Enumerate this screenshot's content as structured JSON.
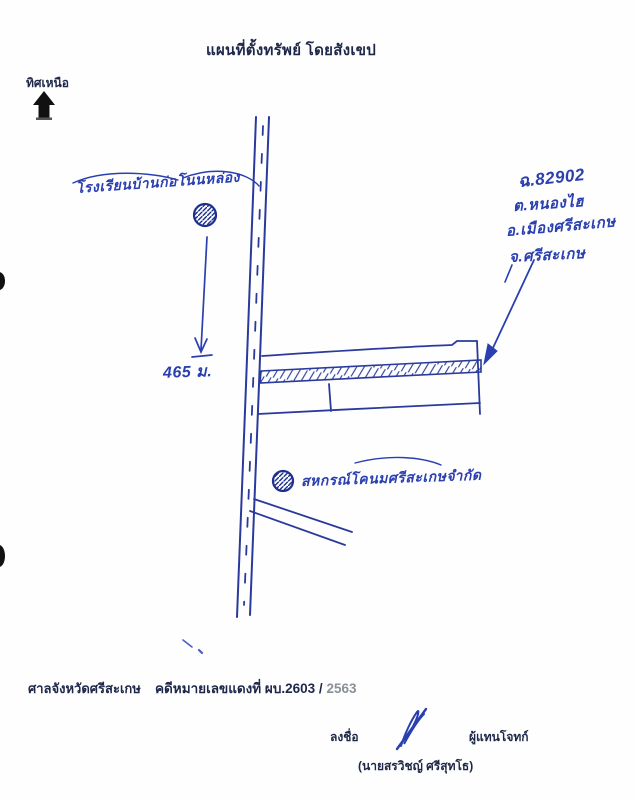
{
  "page": {
    "title": "แผนที่ตั้งทรัพย์ โดยสังเขป",
    "north_label": "ทิศเหนือ"
  },
  "map": {
    "school_label": "โรงเรียนบ้านก่อโนนหล่อง",
    "distance_label": "465 ม.",
    "parcel_note": {
      "line1": "ฉ.82902",
      "line2": "ต.หนองไฮ",
      "line3": "อ.เมืองศรีสะเกษ",
      "line4": "จ.ศรีสะเกษ"
    },
    "coop_label": "สหกรณ์โคนมศรีสะเกษจำกัด"
  },
  "footer": {
    "court_name": "ศาลจังหวัดศรีสะเกษ",
    "case_label": "คดีหมายเลขแดงที่ ผบ.2603 /",
    "case_year": "2563",
    "sign_label": "ลงชื่อ",
    "sign_role": "ผู้แทนโจทก์",
    "sign_name": "(นายสรวิชญ์ ศรีสุทโธ)"
  },
  "icons": {
    "north_arrow": "solid-up-arrow",
    "school_marker": "hatched-circle",
    "coop_marker": "hatched-circle",
    "property_strip": "hatched-band"
  },
  "colors": {
    "printed_ink": "#1e2749",
    "handwriting_ink": "#2a3fb0",
    "drawing_ink": "#2a3a9c",
    "north_arrow": "#111111",
    "year_gray": "#8a8f98",
    "paper": "#fefefe"
  }
}
